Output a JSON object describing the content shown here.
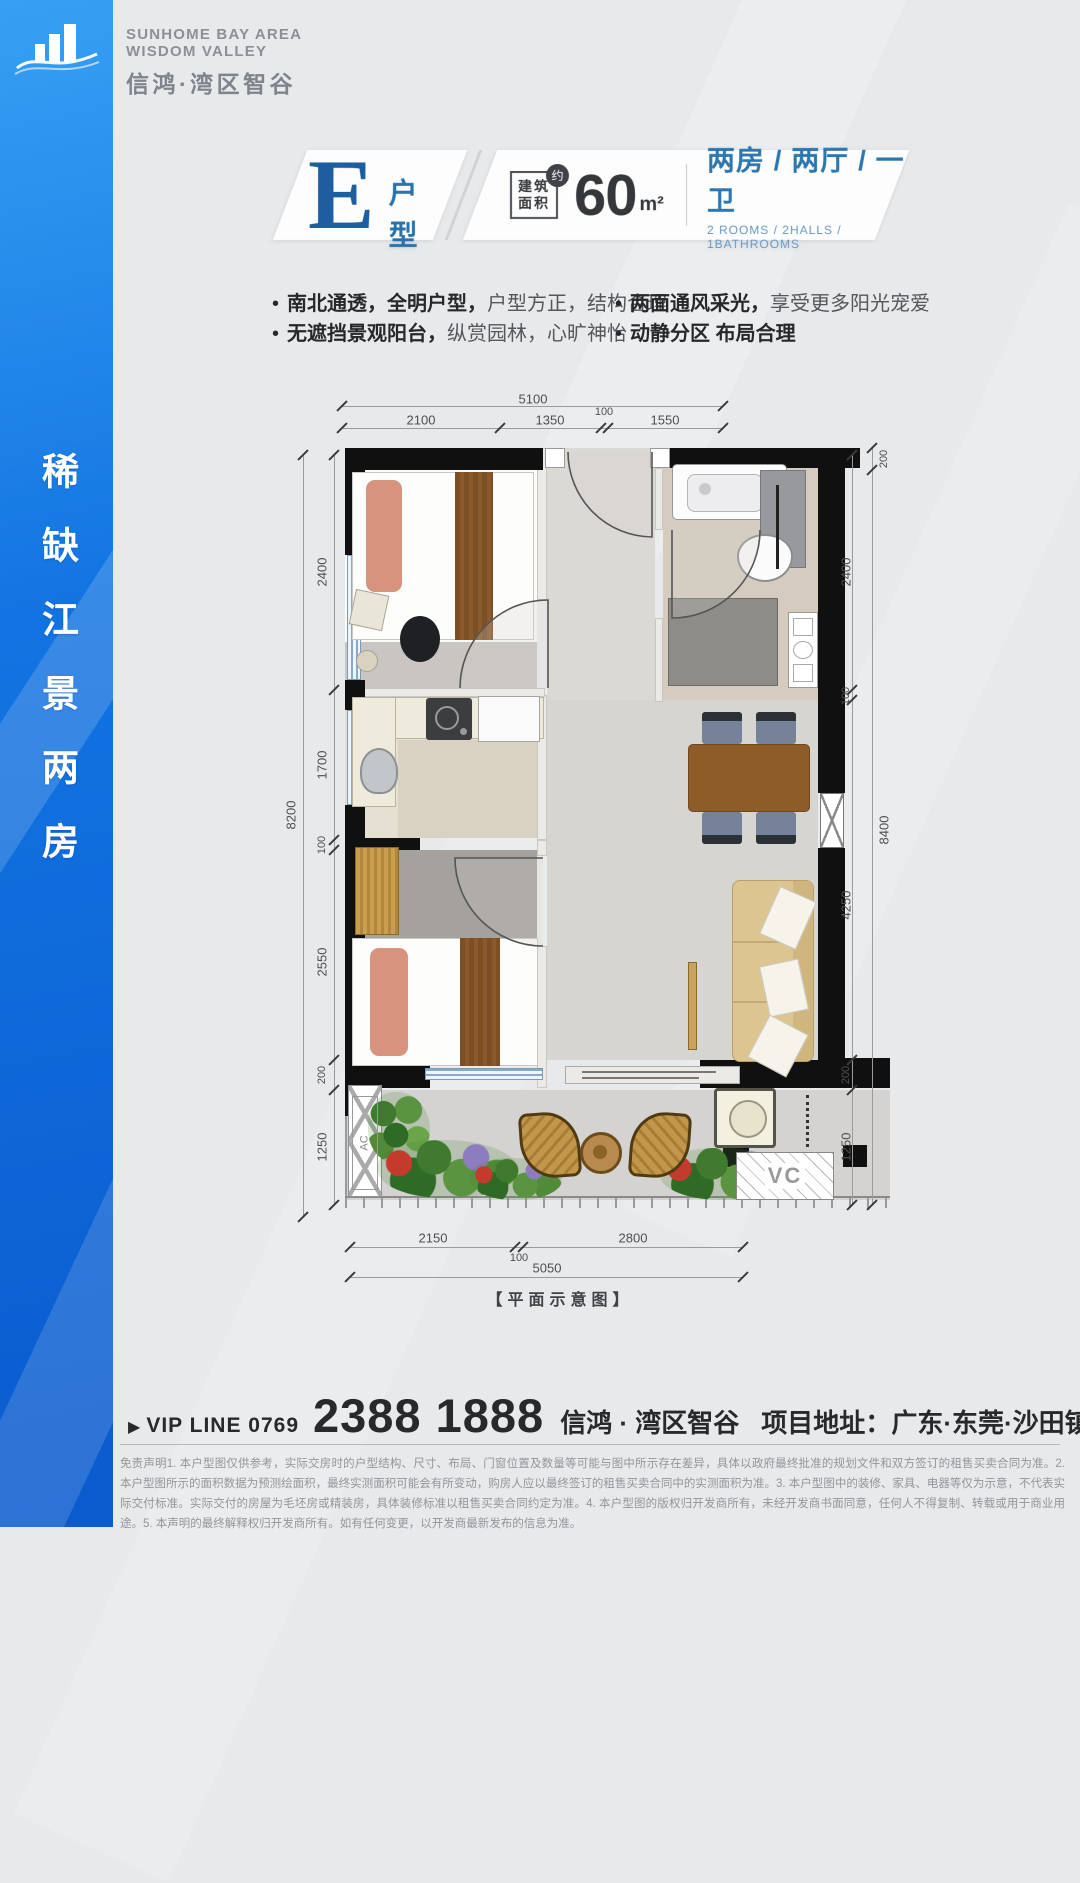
{
  "brand": {
    "en1": "SUNHOME BAY AREA",
    "en2": "WISDOM VALLEY",
    "cn": "信鸿·湾区智谷"
  },
  "banner": {
    "text": "稀缺江景两房"
  },
  "header": {
    "letter": "E",
    "suffix": "户型",
    "area_label_1": "建筑",
    "area_label_2": "面积",
    "approx": "约",
    "area_value": "60",
    "area_unit": "m²",
    "rooms_cn": "两房 / 两厅 / 一卫",
    "rooms_en": "2 ROOMS / 2HALLS / 1BATHROOMS"
  },
  "features": [
    {
      "bold": "南北通透，全明户型，",
      "normal": "户型方正，结构合理"
    },
    {
      "bold": "无遮挡景观阳台，",
      "normal": "纵赏园林，心旷神怡"
    },
    {
      "bold": "两面通风采光，",
      "normal": "享受更多阳光宠爱"
    },
    {
      "bold": "动静分区 布局合理",
      "normal": ""
    }
  ],
  "plan": {
    "caption": "【平面示意图】",
    "ac_label": "AC",
    "vc_label": "VC",
    "annotations": [
      {
        "t": "5100",
        "x": 533,
        "y": 399,
        "r": 0,
        "s": 0
      },
      {
        "t": "2100",
        "x": 421,
        "y": 420,
        "r": 0,
        "s": 0
      },
      {
        "t": "1350",
        "x": 550,
        "y": 420,
        "r": 0,
        "s": 0
      },
      {
        "t": "100",
        "x": 604,
        "y": 412,
        "r": 0,
        "s": 1
      },
      {
        "t": "1550",
        "x": 665,
        "y": 420,
        "r": 0,
        "s": 0
      },
      {
        "t": "8200",
        "x": 291,
        "y": 815,
        "r": 1,
        "s": 0
      },
      {
        "t": "2400",
        "x": 322,
        "y": 572,
        "r": 1,
        "s": 0
      },
      {
        "t": "1700",
        "x": 322,
        "y": 765,
        "r": 1,
        "s": 0
      },
      {
        "t": "100",
        "x": 322,
        "y": 845,
        "r": 1,
        "s": 1
      },
      {
        "t": "2550",
        "x": 322,
        "y": 962,
        "r": 1,
        "s": 0
      },
      {
        "t": "200",
        "x": 322,
        "y": 1075,
        "r": 1,
        "s": 1
      },
      {
        "t": "1250",
        "x": 322,
        "y": 1147,
        "r": 1,
        "s": 0
      },
      {
        "t": "2400",
        "x": 846,
        "y": 572,
        "r": 1,
        "s": 0
      },
      {
        "t": "100",
        "x": 846,
        "y": 696,
        "r": 1,
        "s": 1
      },
      {
        "t": "4250",
        "x": 846,
        "y": 905,
        "r": 1,
        "s": 0
      },
      {
        "t": "200",
        "x": 846,
        "y": 1075,
        "r": 1,
        "s": 1
      },
      {
        "t": "1250",
        "x": 846,
        "y": 1147,
        "r": 1,
        "s": 0
      },
      {
        "t": "200",
        "x": 884,
        "y": 459,
        "r": 1,
        "s": 1
      },
      {
        "t": "8400",
        "x": 884,
        "y": 830,
        "r": 1,
        "s": 0
      },
      {
        "t": "2150",
        "x": 433,
        "y": 1238,
        "r": 0,
        "s": 0
      },
      {
        "t": "100",
        "x": 519,
        "y": 1258,
        "r": 0,
        "s": 1
      },
      {
        "t": "2800",
        "x": 633,
        "y": 1238,
        "r": 0,
        "s": 0
      },
      {
        "t": "5050",
        "x": 547,
        "y": 1268,
        "r": 0,
        "s": 0
      }
    ]
  },
  "footer": {
    "marker": "▶",
    "vip_label": "VIP LINE 0769",
    "phone": "2388 1888",
    "brand": "信鸿 · 湾区智谷",
    "addr_label": "项目地址：",
    "addr": "广东·东莞·沙田镇西太隆",
    "disclaimer": "免责声明1. 本户型图仅供参考，实际交房时的户型结构、尺寸、布局、门窗位置及数量等可能与图中所示存在差异，具体以政府最终批准的规划文件和双方签订的租售买卖合同为准。2. 本户型图所示的面积数据为预测绘面积，最终实测面积可能会有所变动，购房人应以最终签订的租售买卖合同中的实测面积为准。3. 本户型图中的装修、家具、电器等仅为示意，不代表实际交付标准。实际交付的房屋为毛坯房或精装房，具体装修标准以租售买卖合同约定为准。4. 本户型图的版权归开发商所有，未经开发商书面同意，任何人不得复制、转载或用于商业用途。5. 本声明的最终解释权归开发商所有。如有任何变更，以开发商最新发布的信息为准。"
  },
  "colors": {
    "accent_blue": "#1d5ea1",
    "sidebar_blue": "#0f6be0",
    "wall_black": "#101010"
  }
}
